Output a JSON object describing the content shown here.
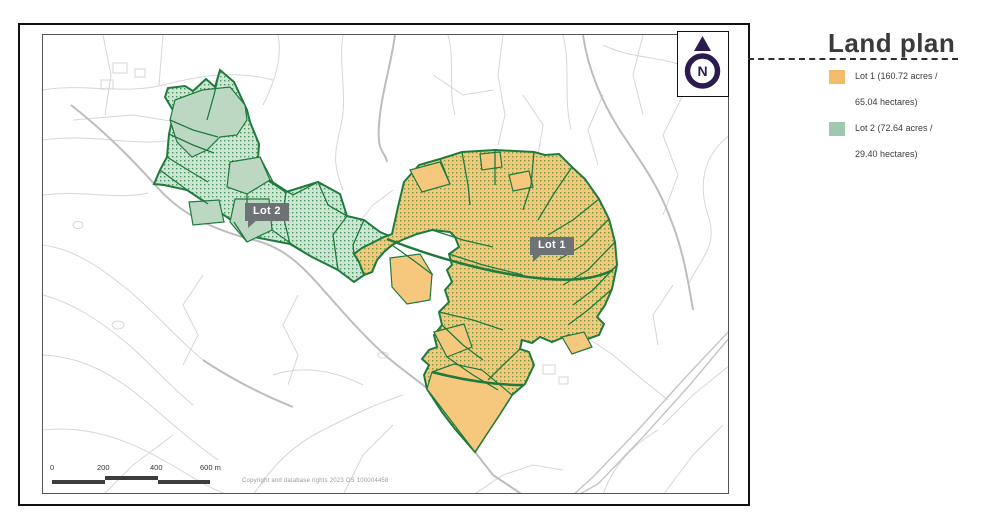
{
  "panel": {
    "title": "Land plan",
    "legend": [
      {
        "swatch": "#f2bc6b",
        "line1": "Lot 1 (160.72 acres /",
        "line2": "65.04 hectares)"
      },
      {
        "swatch": "#9fc9ae",
        "line1": "Lot 2 (72.64 acres /",
        "line2": "29.40 hectares)"
      }
    ]
  },
  "map": {
    "lot1_label": "Lot 1",
    "lot2_label": "Lot 2",
    "compass_letter": "N",
    "scale": {
      "labels": [
        {
          "text": "0"
        },
        {
          "text": "200"
        },
        {
          "text": "400"
        },
        {
          "text": "600 m"
        }
      ]
    },
    "copyright": "Copyright and database rights 2023 OS 100004458",
    "colors": {
      "lot1_fill": "#f6c87e",
      "lot1_dot": "#6f9c3f",
      "lot2_fill": "#cde6d4",
      "lot2_solid": "#bcd8c3",
      "lot2_dot": "#4a9460",
      "boundary_green": "#1f7a3d",
      "background_lines": "#d6d6d6",
      "roads": "#bdbdbd",
      "label_bg": "#6d7275",
      "compass_purple": "#2b1b4f",
      "scale_dark": "#3d3d3d"
    }
  }
}
